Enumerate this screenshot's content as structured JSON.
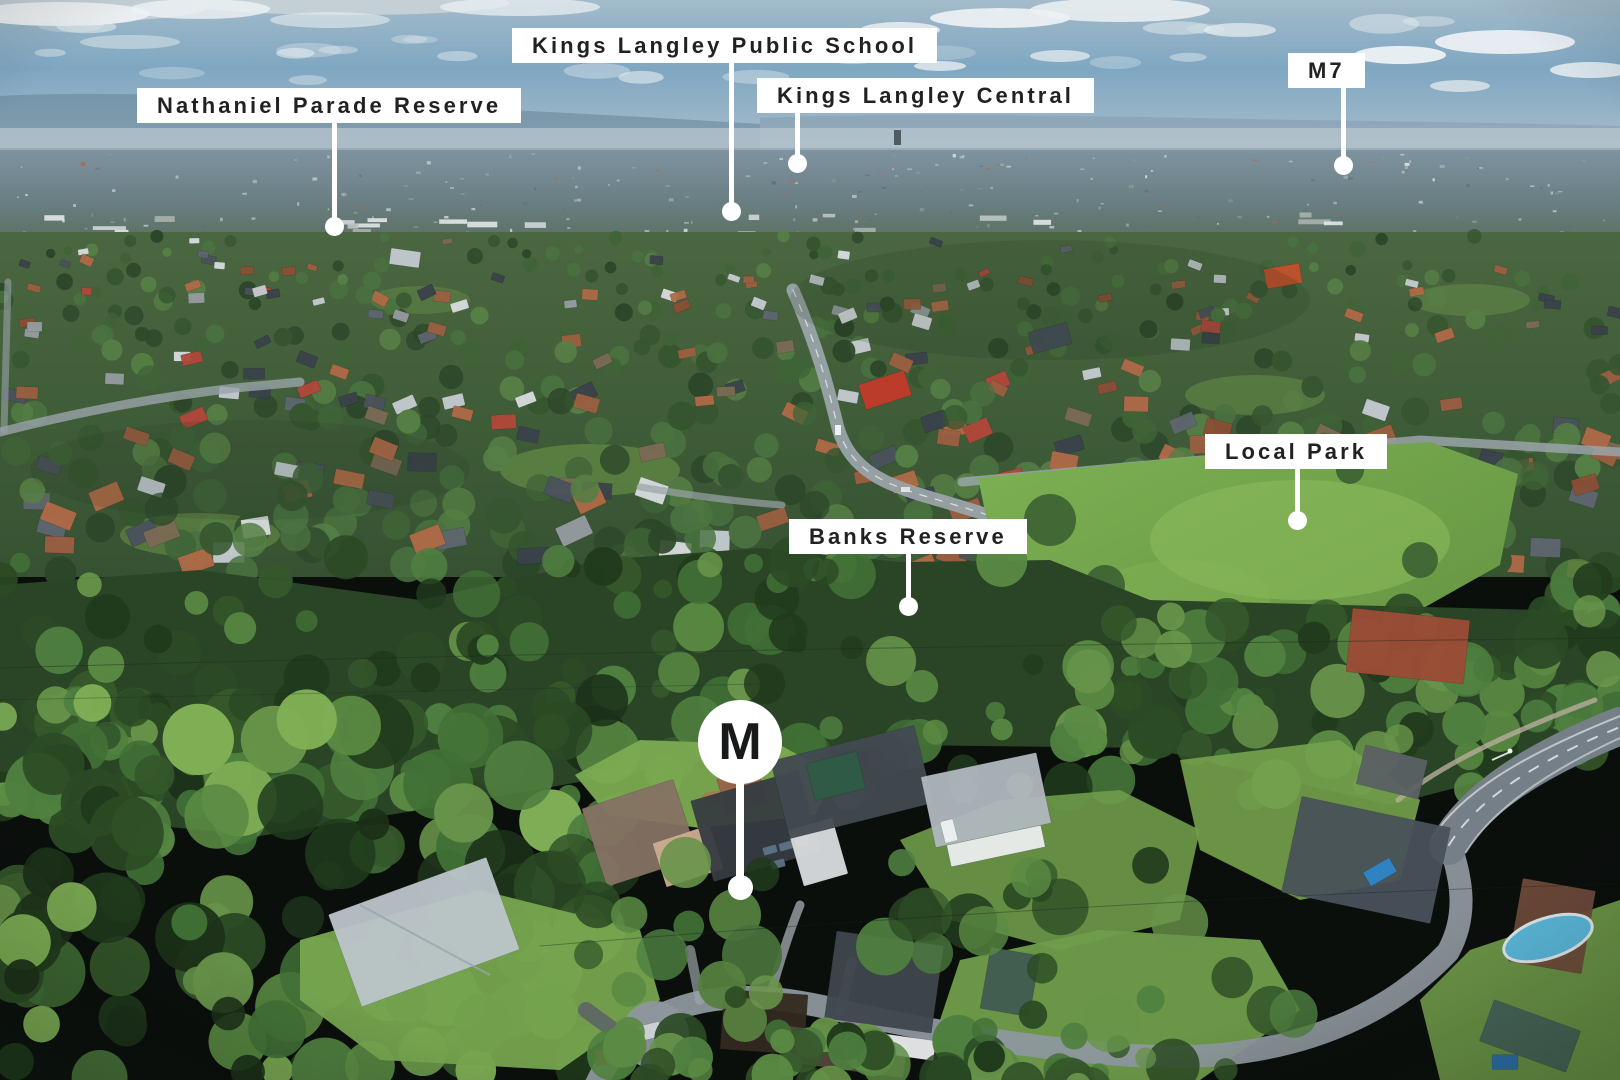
{
  "image_type": "aerial-drone-photograph-with-location-callouts",
  "suburb_scene": "Aerial view over Kings Langley suburb: blue hazy sky and distant city on the horizon, dense tree-filled residential streets in the midground, large green reserves and a dark eucalypt forest band, sunlit houses, lawns and streets in the foreground",
  "style": {
    "label_bg": "#ffffff",
    "label_text": "#1f2123",
    "leader_color": "#ffffff",
    "marker_bg": "#ffffff",
    "marker_text": "#17191b"
  },
  "callouts": [
    {
      "label": "Kings Langley Public School",
      "box_left": 512,
      "box_top": 28,
      "line_x": 731,
      "dot_y": 211
    },
    {
      "label": "Nathaniel Parade Reserve",
      "box_left": 137,
      "box_top": 88,
      "line_x": 334,
      "dot_y": 226
    },
    {
      "label": "Kings Langley Central",
      "box_left": 757,
      "box_top": 78,
      "line_x": 797,
      "dot_y": 163
    },
    {
      "label": "M7",
      "box_left": 1288,
      "box_top": 53,
      "line_x": 1343,
      "dot_y": 165
    },
    {
      "label": "Local Park",
      "box_left": 1205,
      "box_top": 434,
      "line_x": 1297,
      "dot_y": 520
    },
    {
      "label": "Banks Reserve",
      "box_left": 789,
      "box_top": 519,
      "line_x": 908,
      "dot_y": 606
    }
  ],
  "property_marker": {
    "letter": "M",
    "cx": 740,
    "cy": 742,
    "radius": 42,
    "stem_bottom_y": 887
  }
}
